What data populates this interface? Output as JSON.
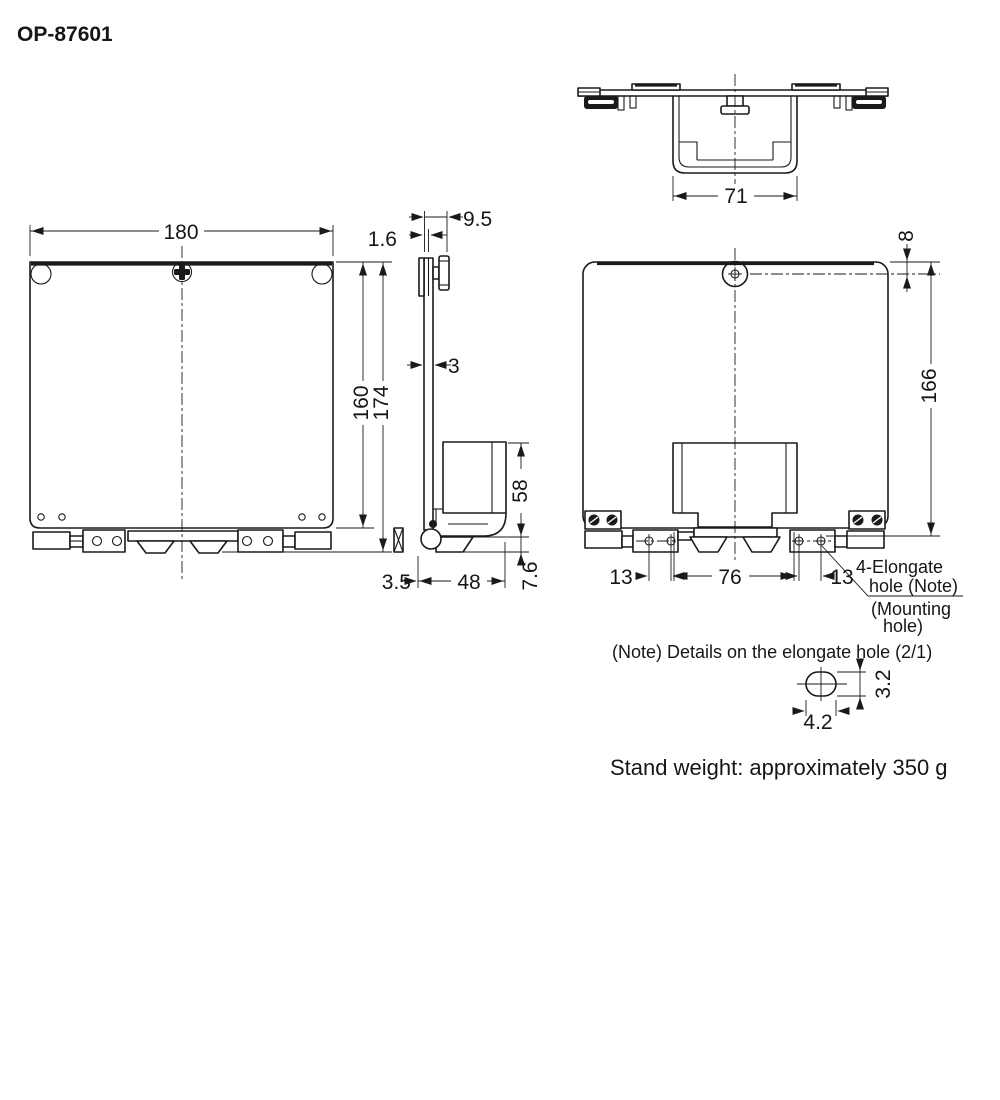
{
  "title": "OP-87601",
  "top_view": {
    "dim_bracket_width": "71"
  },
  "front_view": {
    "dim_width": "180",
    "dim_height_plate": "160",
    "dim_height_total": "174"
  },
  "side_view": {
    "dim_knob_depth": "9.5",
    "dim_plate_thickness": "1.6",
    "dim_mid_thickness": "3",
    "dim_holder_height": "58",
    "dim_foot_height": "7.6",
    "dim_holder_depth": "48",
    "dim_hook_offset": "3.5"
  },
  "rear_view": {
    "dim_hole_from_top": "8",
    "dim_height_from_hole": "166",
    "dim_pitch_left": "13",
    "dim_pitch_center": "76",
    "dim_pitch_right": "13",
    "callout_elongate_1": "4-Elongate",
    "callout_elongate_2": "hole (Note)",
    "callout_mounting_1": "(Mounting",
    "callout_mounting_2": "hole)"
  },
  "detail_view": {
    "note": "(Note) Details on the elongate hole (2/1)",
    "dim_width": "4.2",
    "dim_height": "3.2"
  },
  "footer": {
    "stand_weight": "Stand weight: approximately 350 g"
  }
}
